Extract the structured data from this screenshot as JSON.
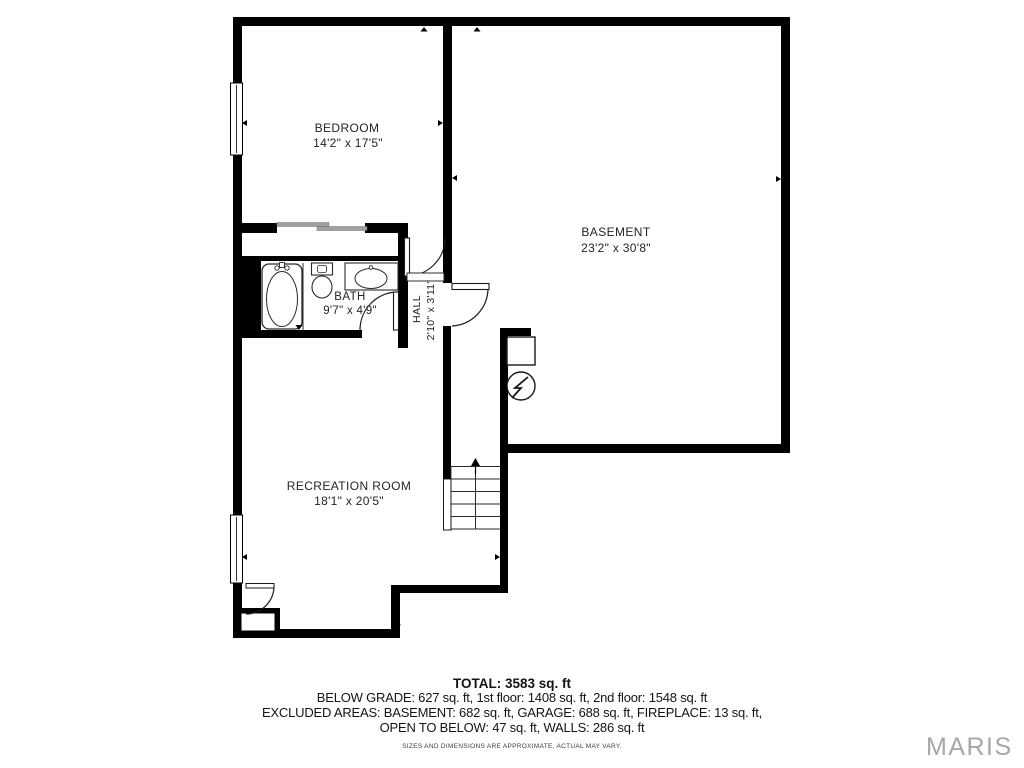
{
  "plan": {
    "rooms": {
      "bedroom": {
        "name": "BEDROOM",
        "dims": "14'2\" x 17'5\""
      },
      "basement": {
        "name": "BASEMENT",
        "dims": "23'2\" x 30'8\""
      },
      "bath": {
        "name": "BATH",
        "dims": "9'7\" x 4'9\""
      },
      "hall": {
        "name": "HALL",
        "dims": "2'10\" x 3'11\""
      },
      "recreation": {
        "name": "RECREATION ROOM",
        "dims": "18'1\" x 20'5\""
      }
    },
    "icons": {
      "water_heater": "water-heater-icon",
      "furnace": "furnace-box",
      "stair_arrow": "stairs-up-arrow"
    }
  },
  "footer": {
    "total": "TOTAL: 3583 sq. ft",
    "line1": "BELOW GRADE: 627 sq. ft, 1st floor: 1408 sq. ft, 2nd floor: 1548 sq. ft",
    "line2": "EXCLUDED AREAS: BASEMENT: 682 sq. ft, GARAGE: 688 sq. ft, FIREPLACE: 13 sq. ft,",
    "line3": "OPEN TO BELOW: 47 sq. ft, WALLS: 286 sq. ft",
    "disclaimer": "SIZES AND DIMENSIONS ARE APPROXIMATE, ACTUAL MAY VARY."
  },
  "watermark": "MARIS",
  "colors": {
    "wall": "#000000",
    "sliding_door": "#a0a0a0",
    "watermark": "#a4a8ab"
  }
}
